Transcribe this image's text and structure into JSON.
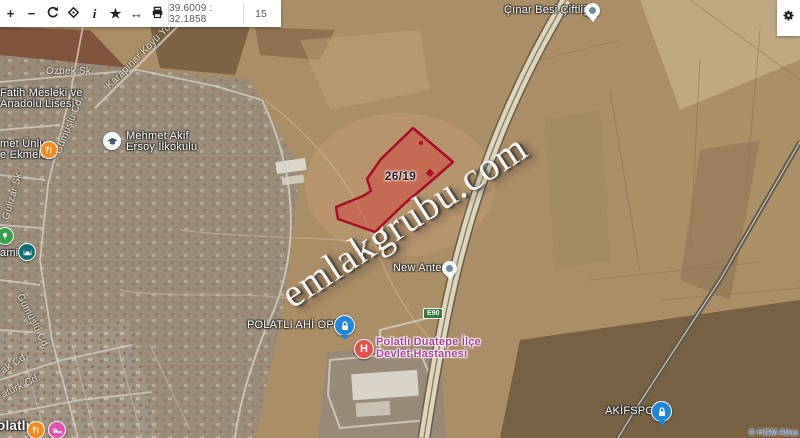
{
  "toolbar": {
    "zoom_in": "+",
    "zoom_out": "−",
    "info": "i",
    "favorite": "★",
    "swap": "↔",
    "coordinates": "39.6009 : 32.1858",
    "zoom_level": "15"
  },
  "watermark": "emlakgrubu.com",
  "parcel": {
    "label": "26/19"
  },
  "labels": {
    "cinar_besi": "Çınar Besi Çiftliği",
    "ozbek": "Özbek Sk.",
    "karapinar": "Karapınar Köyü Yolu",
    "fatih_line1": "Fatih Mesleki ve",
    "fatih_line2": "Anadolu Lisesi",
    "mehmetakif_line1": "Mehmet Akif",
    "mehmetakif_line2": "Ersoy İlkokulu",
    "unlu_line1": "met Ünlü",
    "unlu_line2": "e Ekmek...",
    "gumuslu1": "Gümüşlü Cd.",
    "gulizar": "Gülizar Sk.",
    "cami": "ami",
    "gumuslu2": "Gümüşlü Cd.",
    "ak_cd": "ak Cd.",
    "ataturk_cd": "atürk Cd.",
    "polatli": "olatlı",
    "new_antes": "New Antes",
    "e90": "E90",
    "optik": "POLATLI AHİ OPTİK",
    "hastane_line1": "Polatlı Duatepe İlçe",
    "hastane_line2": "Devlet Hastanesi",
    "akifspor": "AKİFSPOR",
    "attribution": "© HGM Atlas"
  },
  "colors": {
    "parcel_stroke": "#a80d28",
    "parcel_fill": "#d23c32",
    "hospital_label": "#b13ba5",
    "e90_badge": "#2f7d36",
    "pin_blue": "#1d86d8",
    "pin_red": "#e2504c",
    "pin_orange": "#ef8c1f",
    "pin_pink": "#e352ae",
    "watermark_text": "#f7f5f1"
  }
}
